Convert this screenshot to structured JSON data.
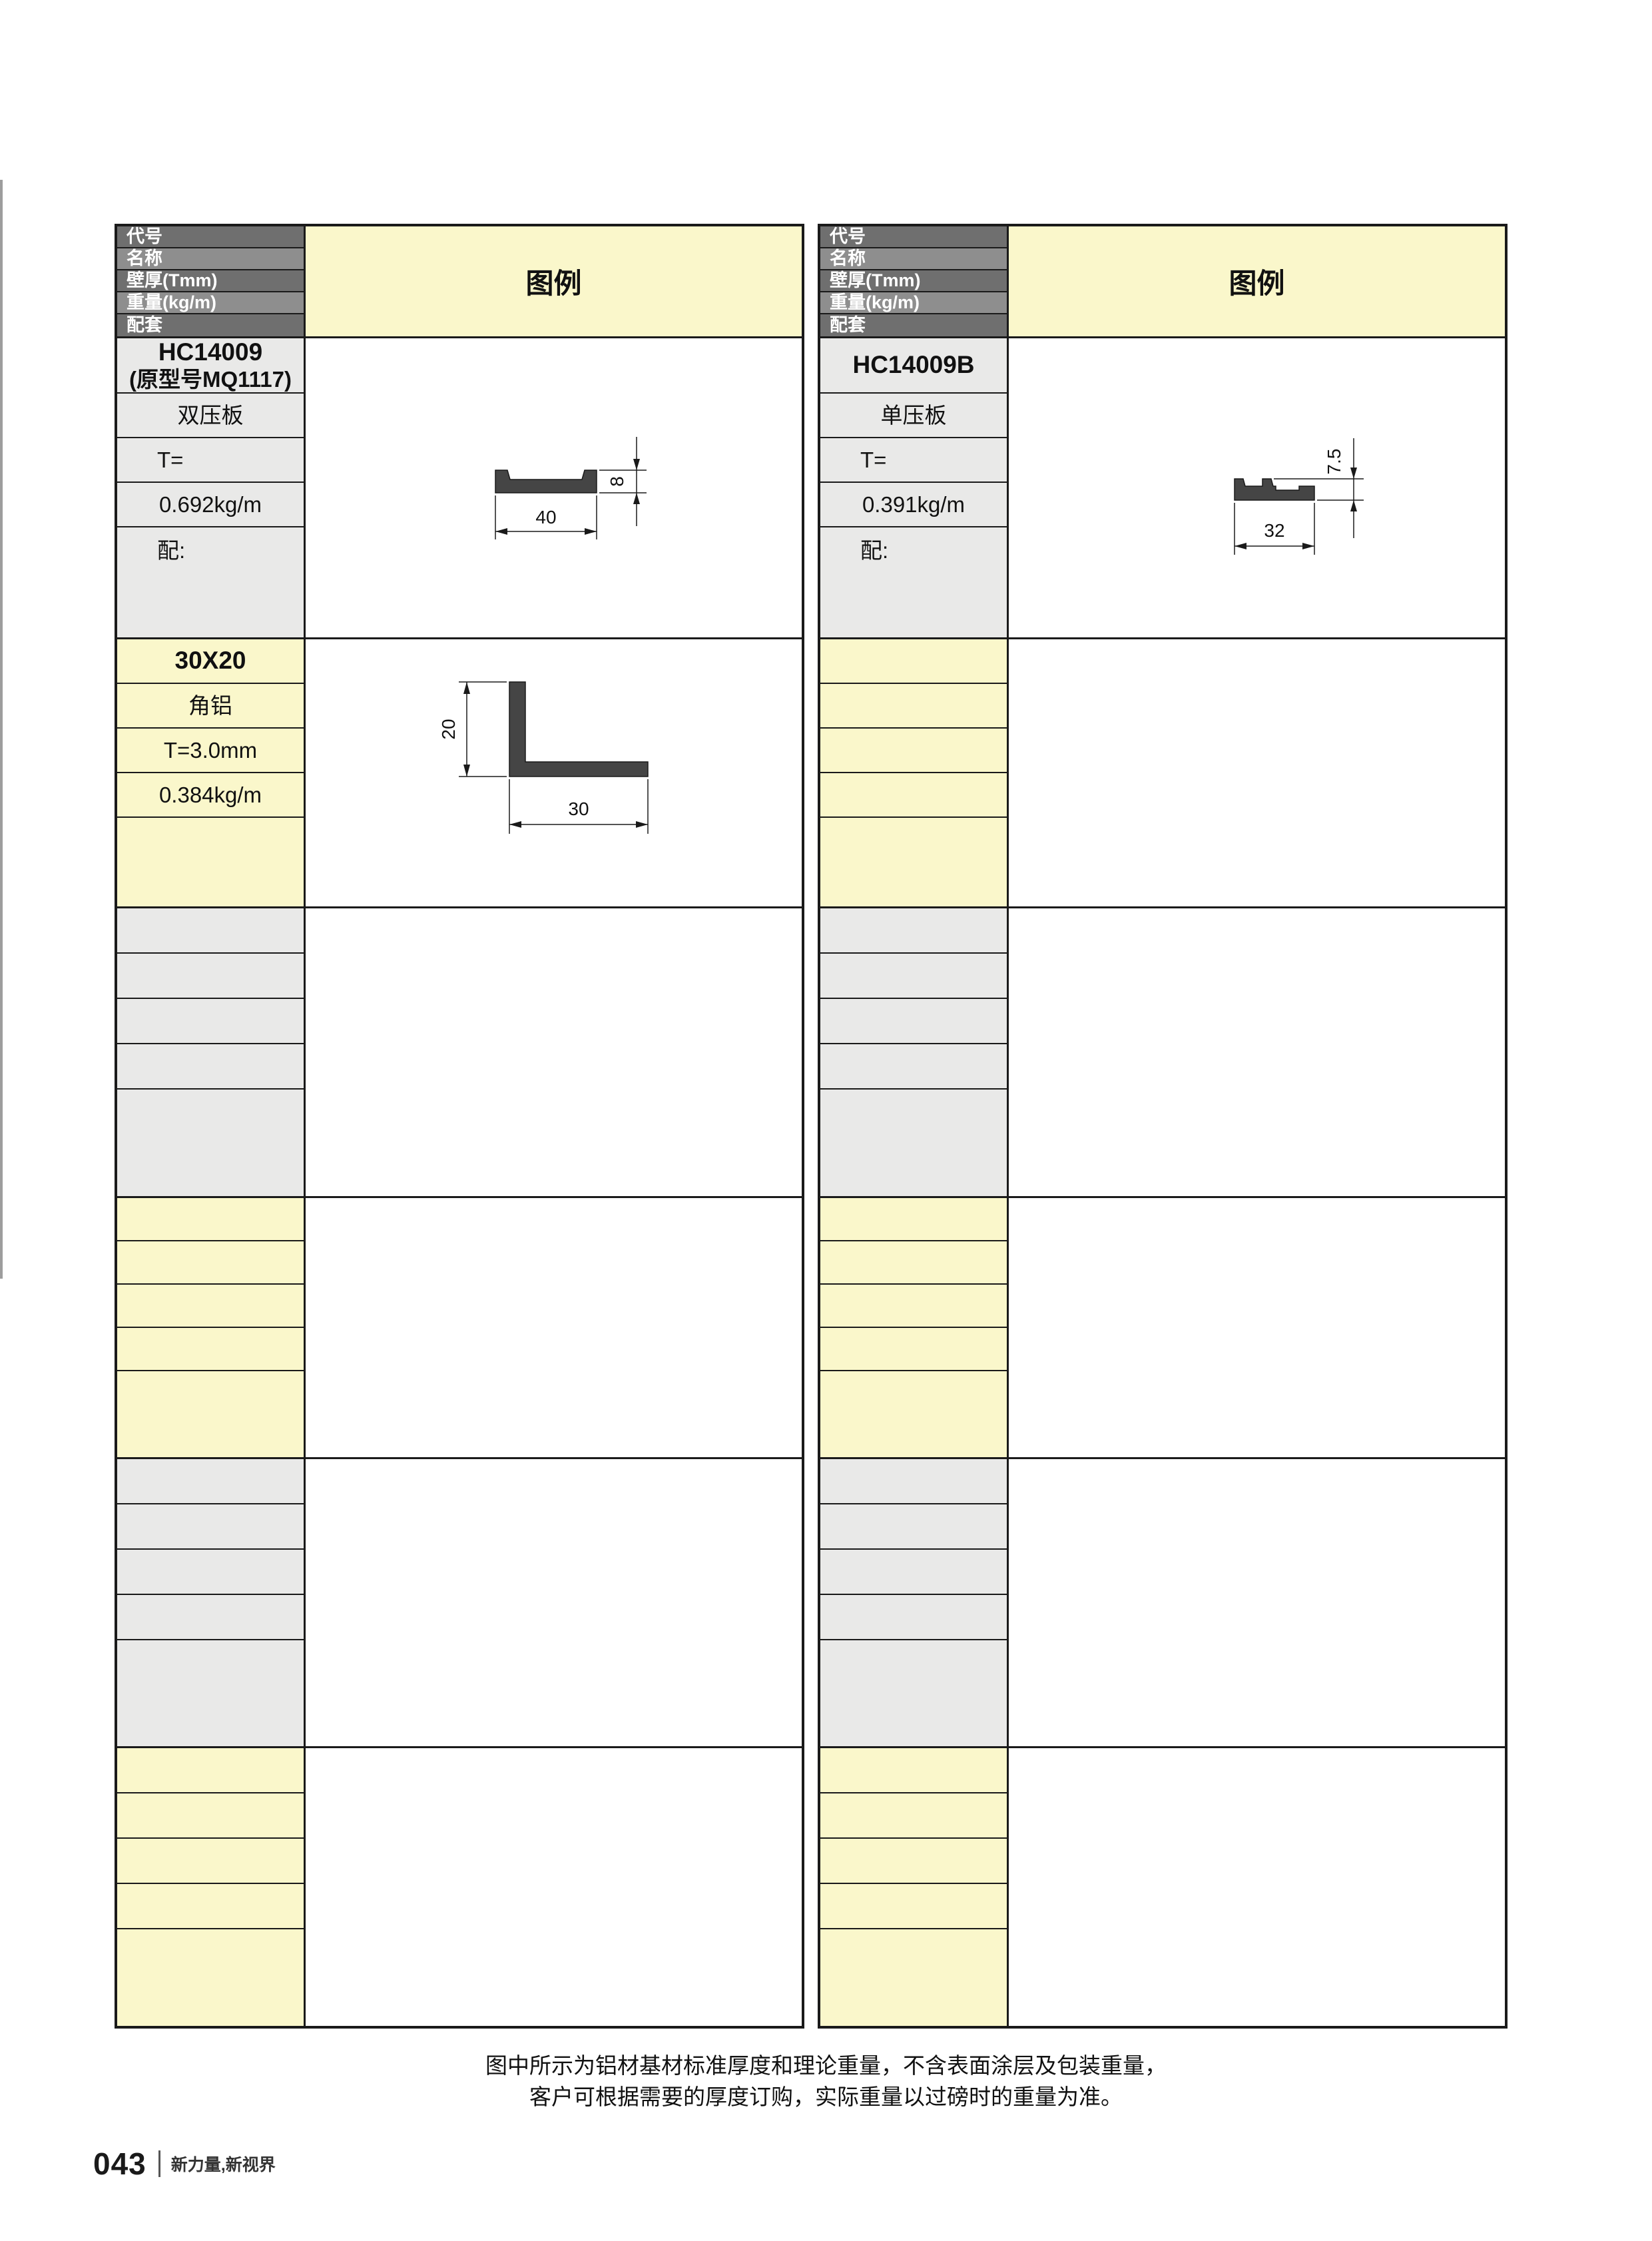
{
  "header_labels": {
    "code": "代号",
    "name": "名称",
    "thickness": "壁厚(Tmm)",
    "weight": "重量(kg/m)",
    "accessory": "配套",
    "legend": "图例"
  },
  "left_table": {
    "product1": {
      "code_line1": "HC14009",
      "code_line2": "(原型号MQ1117)",
      "name": "双压板",
      "thickness": "T=",
      "weight": "0.692kg/m",
      "accessory": "配:",
      "dim_width": "40",
      "dim_height": "8"
    },
    "product2": {
      "code": "30X20",
      "name": "角铝",
      "thickness": "T=3.0mm",
      "weight": "0.384kg/m",
      "dim_width": "30",
      "dim_height": "20"
    }
  },
  "right_table": {
    "product1": {
      "code": "HC14009B",
      "name": "单压板",
      "thickness": "T=",
      "weight": "0.391kg/m",
      "accessory": "配:",
      "dim_width": "32",
      "dim_height": "7.5"
    }
  },
  "footer": {
    "note_line1": "图中所示为铝材基材标准厚度和理论重量，不含表面涂层及包装重量，",
    "note_line2": "客户可根据需要的厚度订购，实际重量以过磅时的重量为准。",
    "page_number": "043",
    "slogan": "新力量,新视界"
  },
  "colors": {
    "legend_yellow": "#FAF7CB",
    "cell_gray": "#E9E9E8",
    "header_dark_gray": "#6F6F6F",
    "header_light_gray": "#8E8E8E",
    "border_black": "#1A1A1A",
    "profile_fill": "#454545"
  }
}
